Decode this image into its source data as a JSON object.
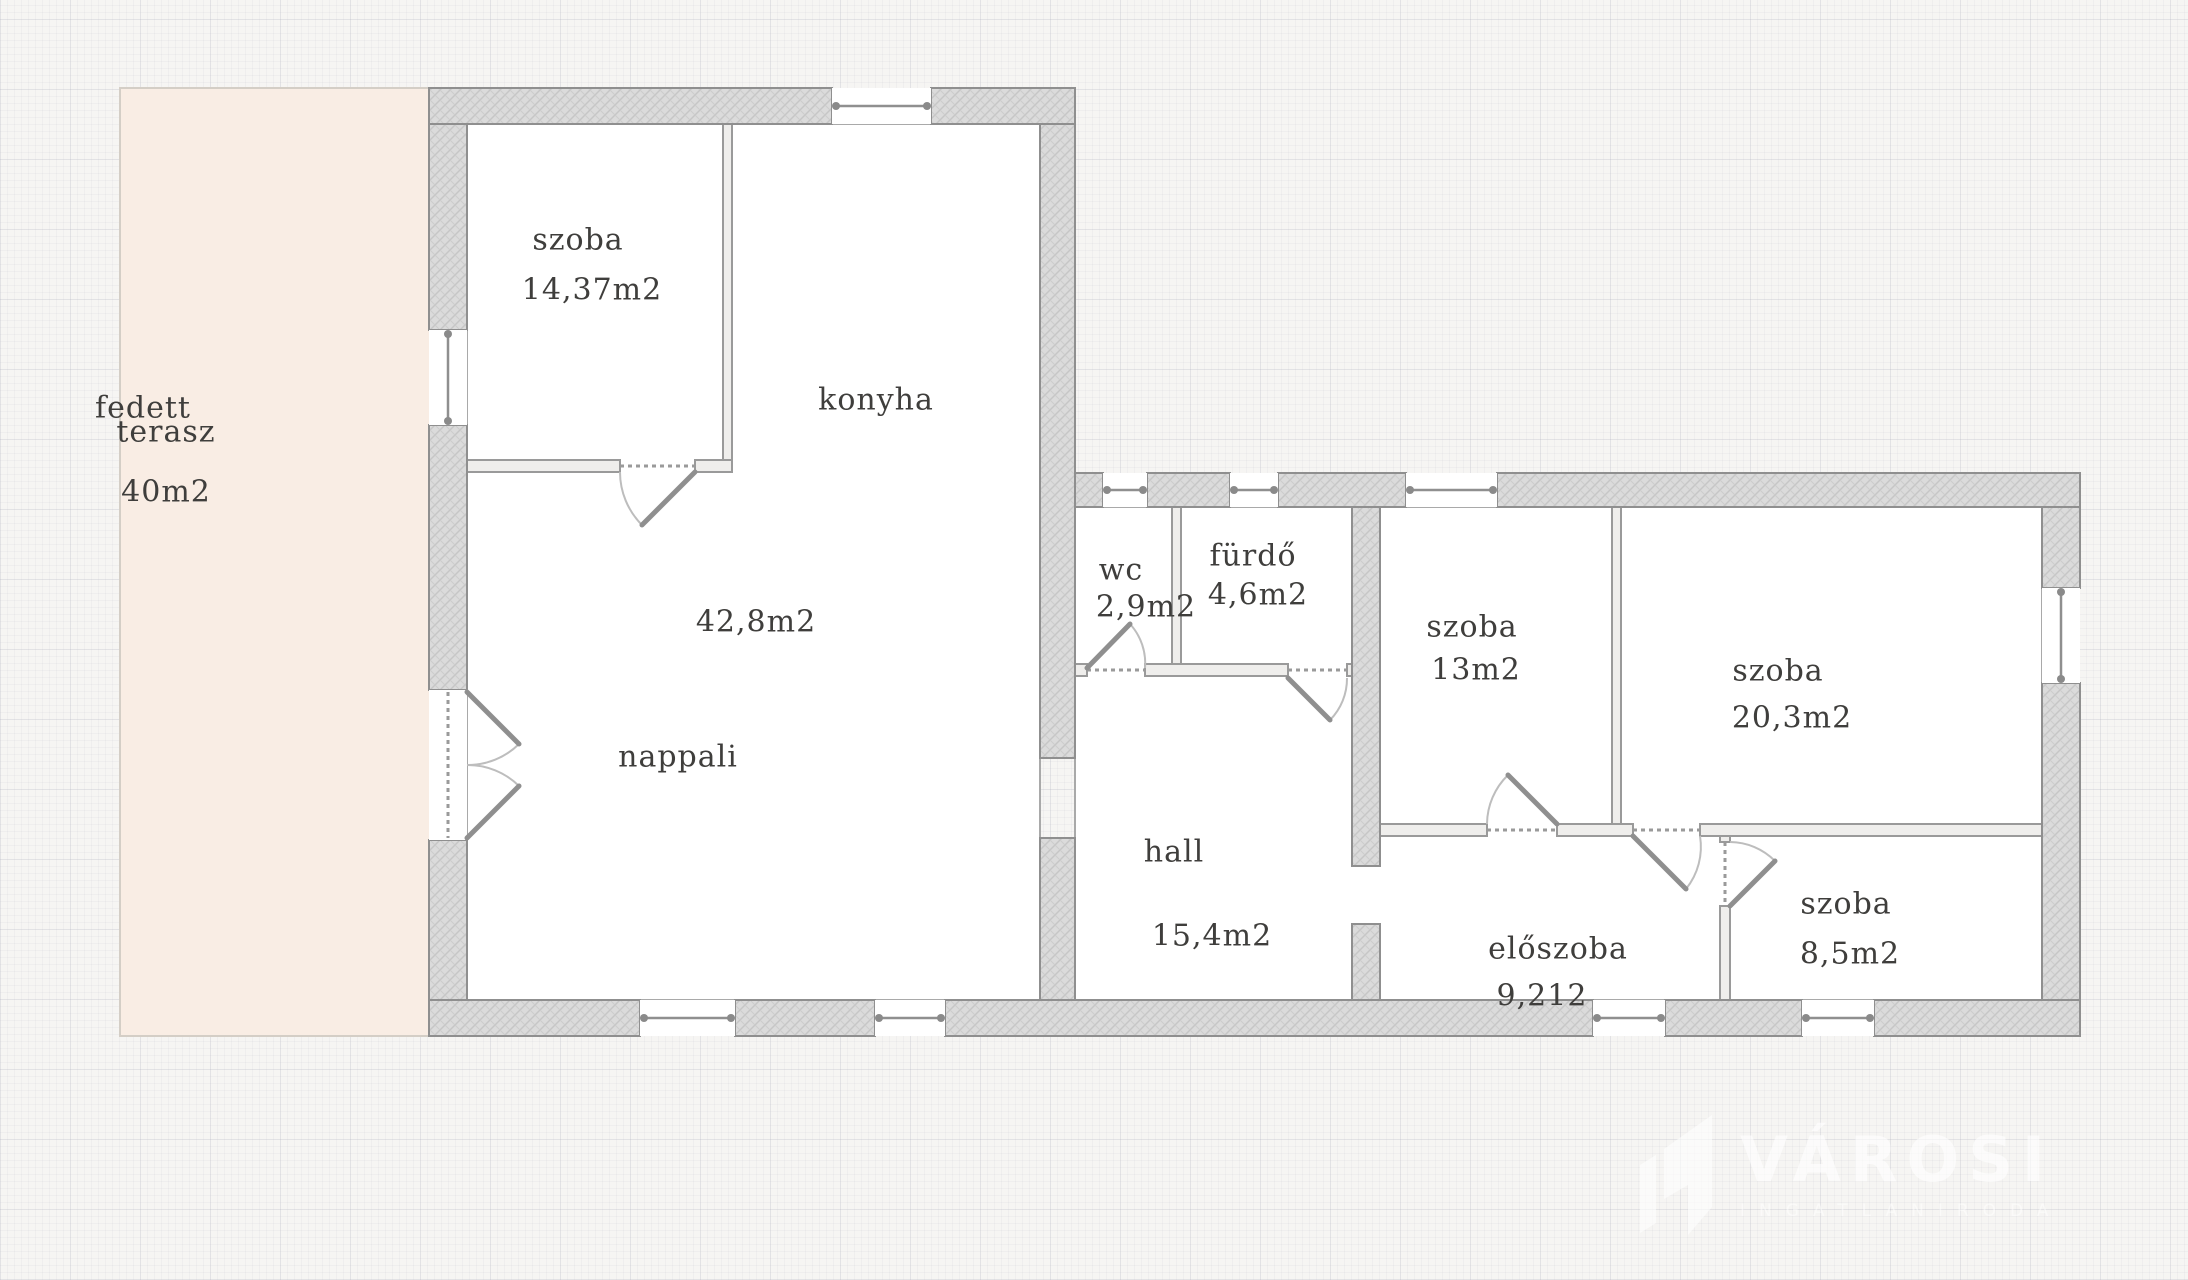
{
  "rooms": {
    "terrace": {
      "line1": "fedett",
      "line2": "terasz",
      "area": "40m2"
    },
    "room1": {
      "name": "szoba",
      "area": "14,37m2"
    },
    "kitchen": {
      "name": "konyha"
    },
    "living": {
      "name": "nappali",
      "area": "42,8m2"
    },
    "wc": {
      "name": "wc",
      "area": "2,9m2"
    },
    "bathroom": {
      "name": "fürdő",
      "area": "4,6m2"
    },
    "room2": {
      "name": "szoba",
      "area": "13m2"
    },
    "room3": {
      "name": "szoba",
      "area": "20,3m2"
    },
    "hall": {
      "name": "hall",
      "area": "15,4m2"
    },
    "entry": {
      "name": "előszoba",
      "area": "9,212"
    },
    "room4": {
      "name": "szoba",
      "area": "8,5m2"
    }
  },
  "watermark": {
    "brand": "VÁROSI",
    "subtitle": "INGATLANIRODA"
  },
  "colors": {
    "background": "#f6f5f3",
    "terrace_fill": "#f9ede4",
    "terrace_border": "#d4cec6",
    "wall_fill": "#dbdbdb",
    "wall_hatch": "#c6c6c6",
    "wall_line": "#8f8f8f",
    "thin_wall_fill": "#efeeec",
    "room_fill": "#ffffff",
    "door_arc": "#b9b9b9",
    "text": "#3f3e3c",
    "watermark": "#ffffff"
  }
}
